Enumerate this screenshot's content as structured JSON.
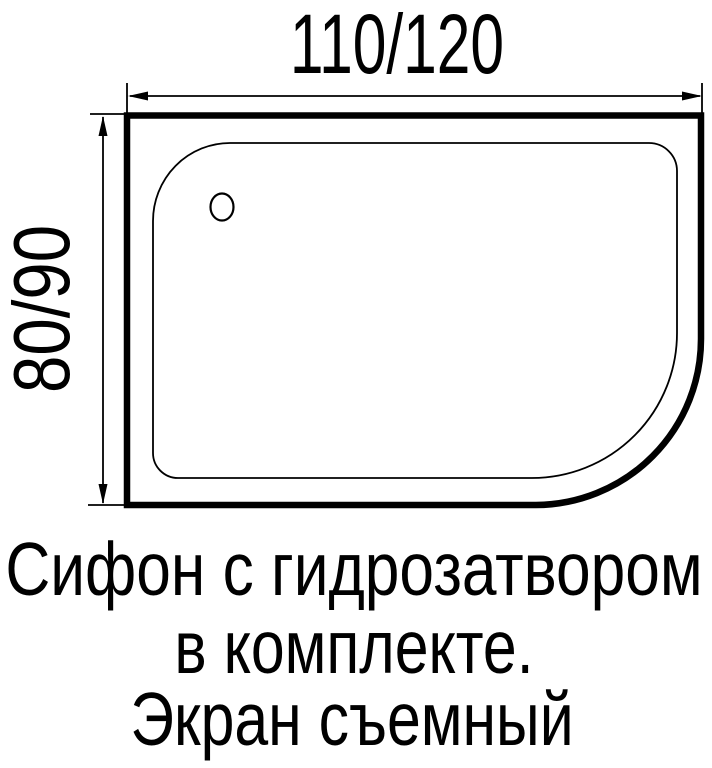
{
  "dimensions": {
    "width_label": "110/120",
    "depth_label": "80/90"
  },
  "caption": {
    "line1": "Сифон с гидрозатвором",
    "line2": "в комплекте.",
    "line3": "Экран съемный"
  },
  "colors": {
    "ink": "#000000",
    "background": "#ffffff"
  }
}
